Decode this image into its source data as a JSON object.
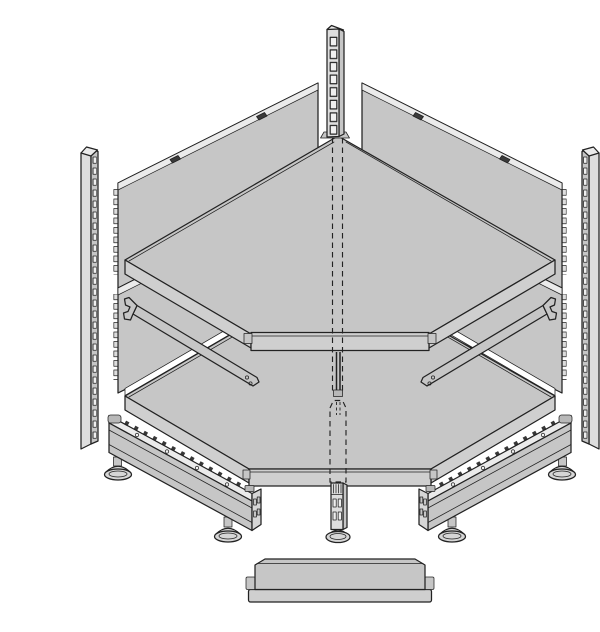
{
  "diagram": {
    "title": "Exploded assembly diagram — corner gondola shelving unit",
    "background": "#ffffff",
    "colors": {
      "face": "#c6c6c6",
      "light": "#dedede",
      "top": "#ebebeb",
      "fascia": "#cfcfcf",
      "slot": "#f0f0f0",
      "cap": "#d6d6d6",
      "metal": "#b8b8b8",
      "line": "#222222",
      "white": "#ffffff",
      "dark": "#3a3a3a",
      "background": "#ffffff"
    },
    "parts": {
      "back_center_upright": "Slotted corner back upright",
      "left_upright": "Left slotted upright post",
      "right_upright": "Right slotted upright post",
      "upper_left_panel": "Upper left back panel",
      "upper_right_panel": "Upper right back panel",
      "lower_left_panel": "Lower left back panel",
      "lower_right_panel": "Lower right back panel",
      "top_shelf": "Upper corner shelf",
      "lower_shelf": "Lower corner shelf",
      "left_bracket": "Left shelf support bracket",
      "right_bracket": "Right shelf support bracket",
      "left_base_leg": "Left base leg with adjustable feet",
      "right_base_leg": "Right base leg with adjustable feet",
      "center_foot": "Centre foot with adjustable glide",
      "center_line": "Hidden centre line (dashed)",
      "kick_plate": "Front kick plate"
    }
  }
}
